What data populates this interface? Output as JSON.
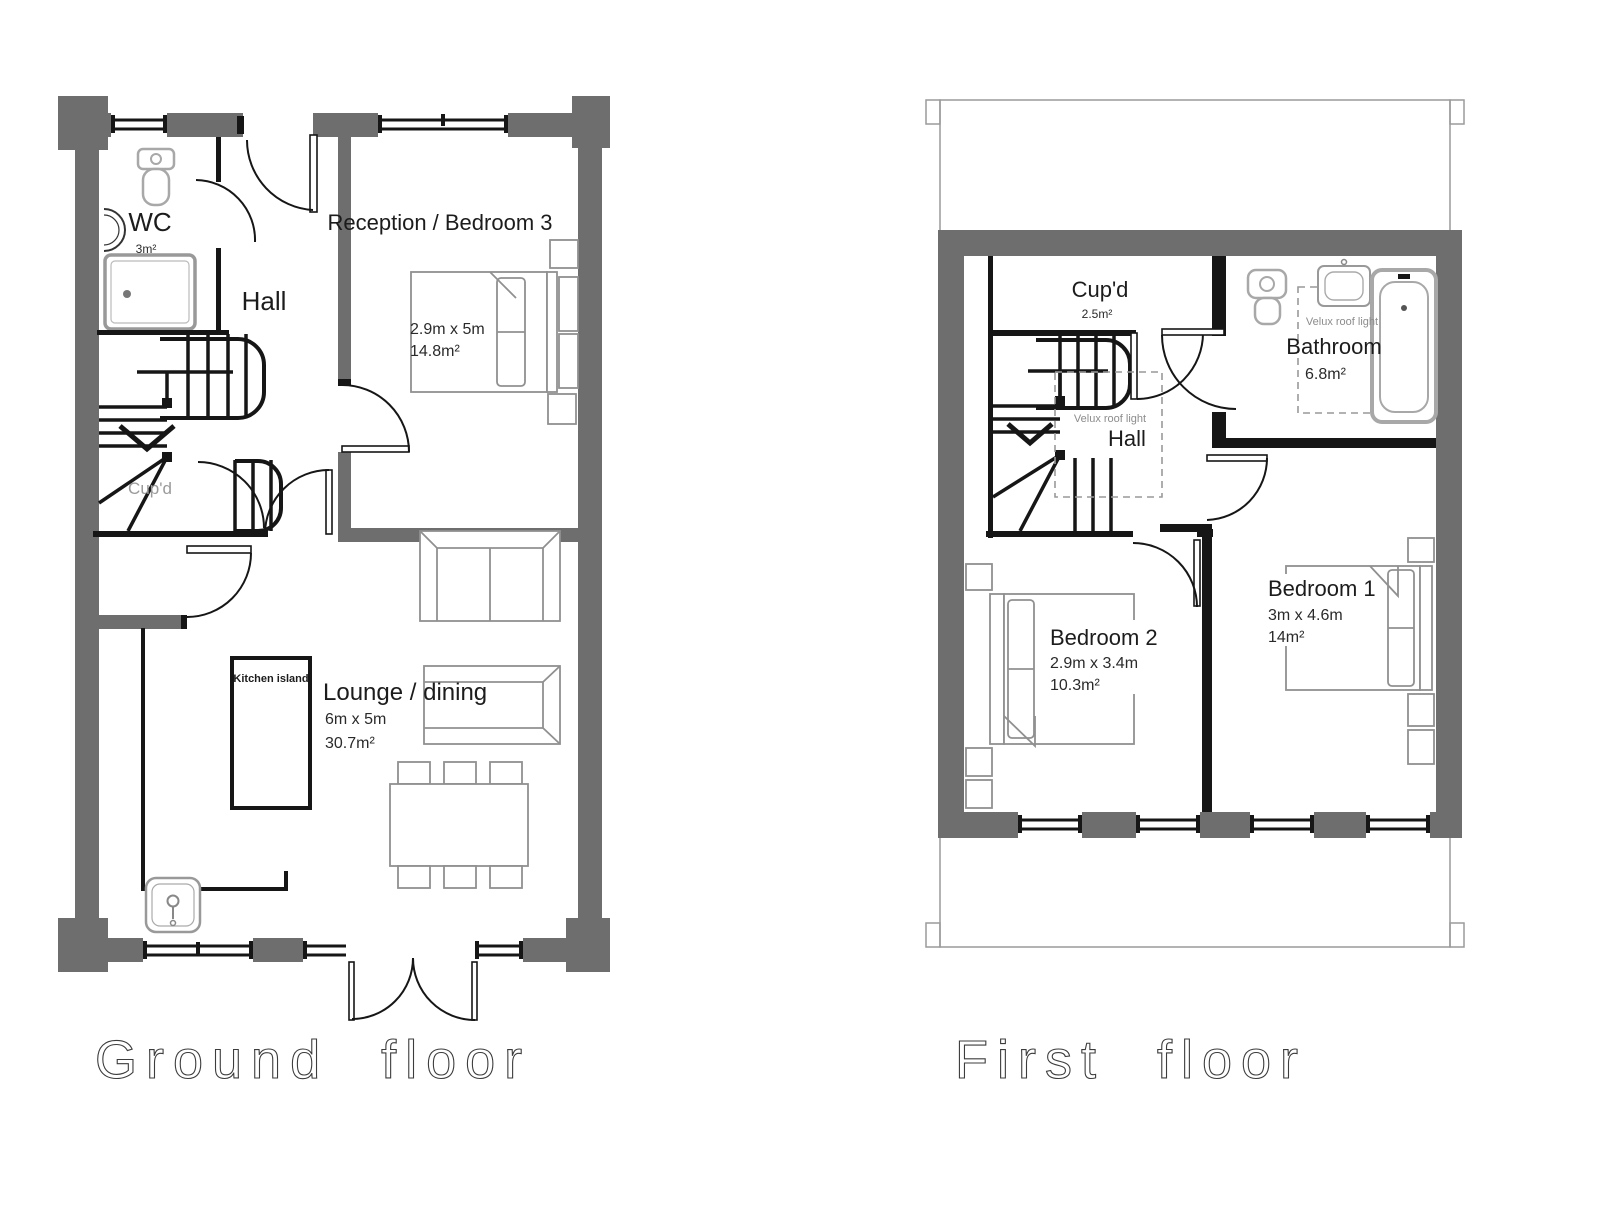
{
  "ground": {
    "title": "Ground floor",
    "rooms": {
      "wc": {
        "name": "WC",
        "area": "3m²"
      },
      "hall": {
        "name": "Hall"
      },
      "reception": {
        "name": "Reception / Bedroom 3",
        "dims": "2.9m x 5m",
        "area": "14.8m²"
      },
      "cupboard": {
        "name": "Cup'd"
      },
      "lounge": {
        "name": "Lounge / dining",
        "dims": "6m x 5m",
        "area": "30.7m²"
      },
      "kitchen_island": {
        "name": "Kitchen island"
      }
    }
  },
  "first": {
    "title": "First floor",
    "rooms": {
      "cupboard": {
        "name": "Cup'd",
        "area": "2.5m²"
      },
      "hall": {
        "name": "Hall",
        "velux": "Velux roof light"
      },
      "bathroom": {
        "name": "Bathroom",
        "area": "6.8m²",
        "velux": "Velux roof light"
      },
      "bedroom2": {
        "name": "Bedroom 2",
        "dims": "2.9m x 3.4m",
        "area": "10.3m²"
      },
      "bedroom1": {
        "name": "Bedroom 1",
        "dims": "3m x 4.6m",
        "area": "14m²"
      }
    }
  },
  "colors": {
    "wall": "#6e6e6e",
    "line": "#161616",
    "fixture": "#a8a8a8",
    "muted": "#8c8c8c",
    "background": "#ffffff"
  }
}
